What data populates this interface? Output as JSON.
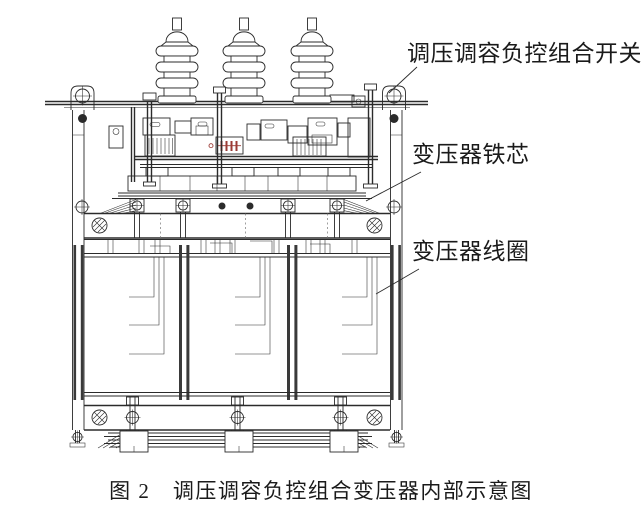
{
  "figure_caption": "图 2　调压调容负控组合变压器内部示意图",
  "callouts": {
    "switch": "调压调容负控组合开关",
    "iron_core": "变压器铁芯",
    "coil": "变压器线圈"
  },
  "colors": {
    "line": "#2b2b2b",
    "text": "#1a1a1a",
    "accent_red": "#9b3a34",
    "background": "#ffffff"
  }
}
